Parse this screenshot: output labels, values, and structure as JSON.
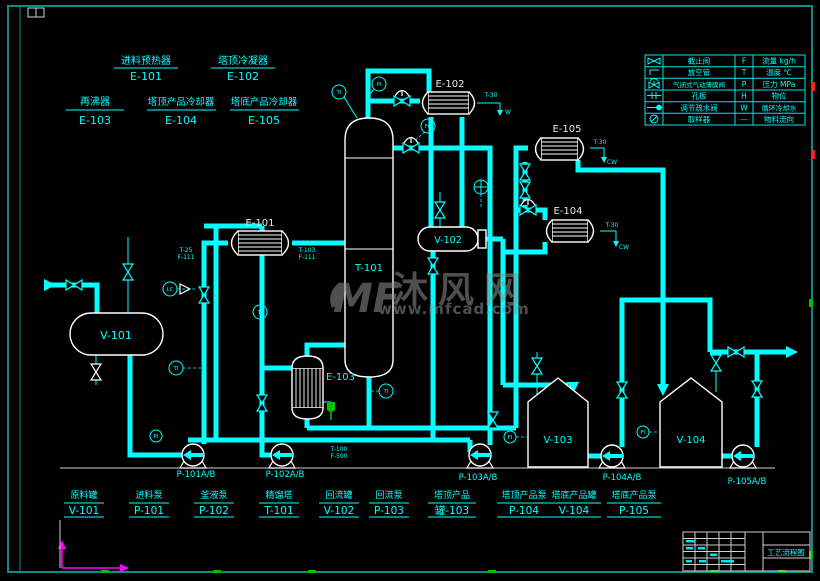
{
  "colors": {
    "background": "#000000",
    "pipe": "#00FFFF",
    "equipment": "#FFFFFF",
    "border": "#0E8A8A",
    "green": "#00C000",
    "magenta": "#FF00FF",
    "red": "#FF2020",
    "watermark": "#909090"
  },
  "equipment_legend": [
    {
      "name": "进料预热器",
      "tag": "E-101"
    },
    {
      "name": "塔顶冷凝器",
      "tag": "E-102"
    },
    {
      "name": "再沸器",
      "tag": "E-103"
    },
    {
      "name": "塔顶产品冷却器",
      "tag": "E-104"
    },
    {
      "name": "塔底产品冷却器",
      "tag": "E-105"
    }
  ],
  "symbol_legend": {
    "rows": [
      {
        "name": "截止阀",
        "code": "F",
        "meaning": "流量 kg/h"
      },
      {
        "name": "放空管",
        "code": "T",
        "meaning": "温度 ℃"
      },
      {
        "name": "气闭式气动薄膜阀",
        "code": "P",
        "meaning": "压力 MPa"
      },
      {
        "name": "孔板",
        "code": "H",
        "meaning": "物位"
      },
      {
        "name": "调节疏水阀",
        "code": "W",
        "meaning": "循环冷却水"
      },
      {
        "name": "取样器",
        "code": "—",
        "meaning": "物料流向"
      }
    ]
  },
  "equipment_tags": {
    "v101": "V-101",
    "e101": "E-101",
    "t101": "T-101",
    "e102": "E-102",
    "e103": "E-103",
    "e104": "E-104",
    "e105": "E-105",
    "v102": "V-102",
    "v103": "V-103",
    "v104": "V-104"
  },
  "pump_tags": {
    "p101": "P-101A/B",
    "p102": "P-102A/B",
    "p103": "P-103A/B",
    "p104": "P-104A/B",
    "p105": "P-105A/B"
  },
  "bottom_legend": [
    {
      "name": "原料罐",
      "tag": "V-101"
    },
    {
      "name": "进料泵",
      "tag": "P-101"
    },
    {
      "name": "釜液泵",
      "tag": "P-102"
    },
    {
      "name": "精馏塔",
      "tag": "T-101"
    },
    {
      "name": "回流罐",
      "tag": "V-102"
    },
    {
      "name": "回流泵",
      "tag": "P-103"
    },
    {
      "name": "塔顶产品",
      "tag": "罐-103"
    },
    {
      "name": "塔顶产品泵",
      "tag": "P-104"
    },
    {
      "name": "塔底产品罐",
      "tag": "V-104"
    },
    {
      "name": "塔底产品泵",
      "tag": "P-105"
    }
  ],
  "instruments": {
    "lc": "LC",
    "ti": "TI",
    "pi": "PI",
    "fc": "FC",
    "fi": "FI"
  },
  "stream_labels": {
    "feed_t": "T-25",
    "feed_f": "F-111",
    "feed2_t": "T-103",
    "feed2_f": "F-111",
    "bottoms_t": "T-100",
    "bottoms_f": "F-500",
    "cw_t": "T-30",
    "cw": "CW",
    "w": "W"
  },
  "watermark": {
    "logo_text": "MF",
    "brand": "沐风网",
    "url": "www.mfcad.com"
  },
  "title_block": {
    "drawing_title": "工艺流程图"
  }
}
